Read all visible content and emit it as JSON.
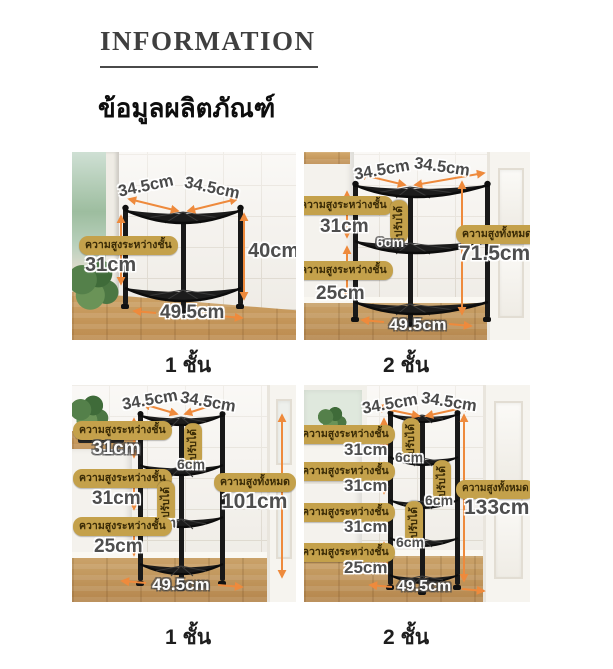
{
  "header": {
    "title": "INFORMATION",
    "subtitle": "ข้อมูลผลิตภัณฑ์"
  },
  "colors": {
    "badge_gold": "#c4a14b",
    "badge_text": "#3a2b06",
    "arrow_orange": "#ee8a3c"
  },
  "panels": {
    "p1": {
      "caption": "1 ชั้น",
      "width_top_left": "34.5cm",
      "width_top_right": "34.5cm",
      "width_bottom": "49.5cm",
      "height_value": "40cm",
      "gap1_label": "ความสูงระหว่างชั้น",
      "gap1_value": "31cm"
    },
    "p2": {
      "caption": "2 ชั้น",
      "width_top_left": "34.5cm",
      "width_top_right": "34.5cm",
      "width_bottom": "49.5cm",
      "gap1_label": "ความสูงระหว่างชั้น",
      "gap1_value": "31cm",
      "adj1_label": "ปรับได้",
      "adj1_value": "6cm",
      "gap2_label": "ความสูงระหว่างชั้น",
      "gap2_value": "25cm",
      "total_label": "ความสูงทั้งหมด",
      "total_value": "71.5cm"
    },
    "p3": {
      "caption": "1 ชั้น",
      "width_top_left": "34.5cm",
      "width_top_right": "34.5cm",
      "width_bottom": "49.5cm",
      "gap1_label": "ความสูงระหว่างชั้น",
      "gap1_value": "31cm",
      "adj1_label": "ปรับได้",
      "adj1_value": "6cm",
      "gap2_label": "ความสูงระหว่างชั้น",
      "gap2_value": "31cm",
      "adj2_label": "ปรับได้",
      "adj2_value": "6cm",
      "gap3_label": "ความสูงระหว่างชั้น",
      "gap3_value": "25cm",
      "total_label": "ความสูงทั้งหมด",
      "total_value": "101cm"
    },
    "p4": {
      "caption": "2 ชั้น",
      "width_top_left": "34.5cm",
      "width_top_right": "34.5cm",
      "width_bottom": "49.5cm",
      "gap1_label": "ความสูงระหว่างชั้น",
      "gap1_value": "31cm",
      "adj1_label": "ปรับได้",
      "adj1_value": "6cm",
      "gap2_label": "ความสูงระหว่างชั้น",
      "gap2_value": "31cm",
      "adj2_label": "ปรับได้",
      "adj2_value": "6cm",
      "gap3_label": "ความสูงระหว่างชั้น",
      "gap3_value": "31cm",
      "adj3_label": "ปรับได้",
      "adj3_value": "6cm",
      "gap4_label": "ความสูงระหว่างชั้น",
      "gap4_value": "25cm",
      "total_label": "ความสูงทั้งหมด",
      "total_value": "133cm"
    }
  }
}
